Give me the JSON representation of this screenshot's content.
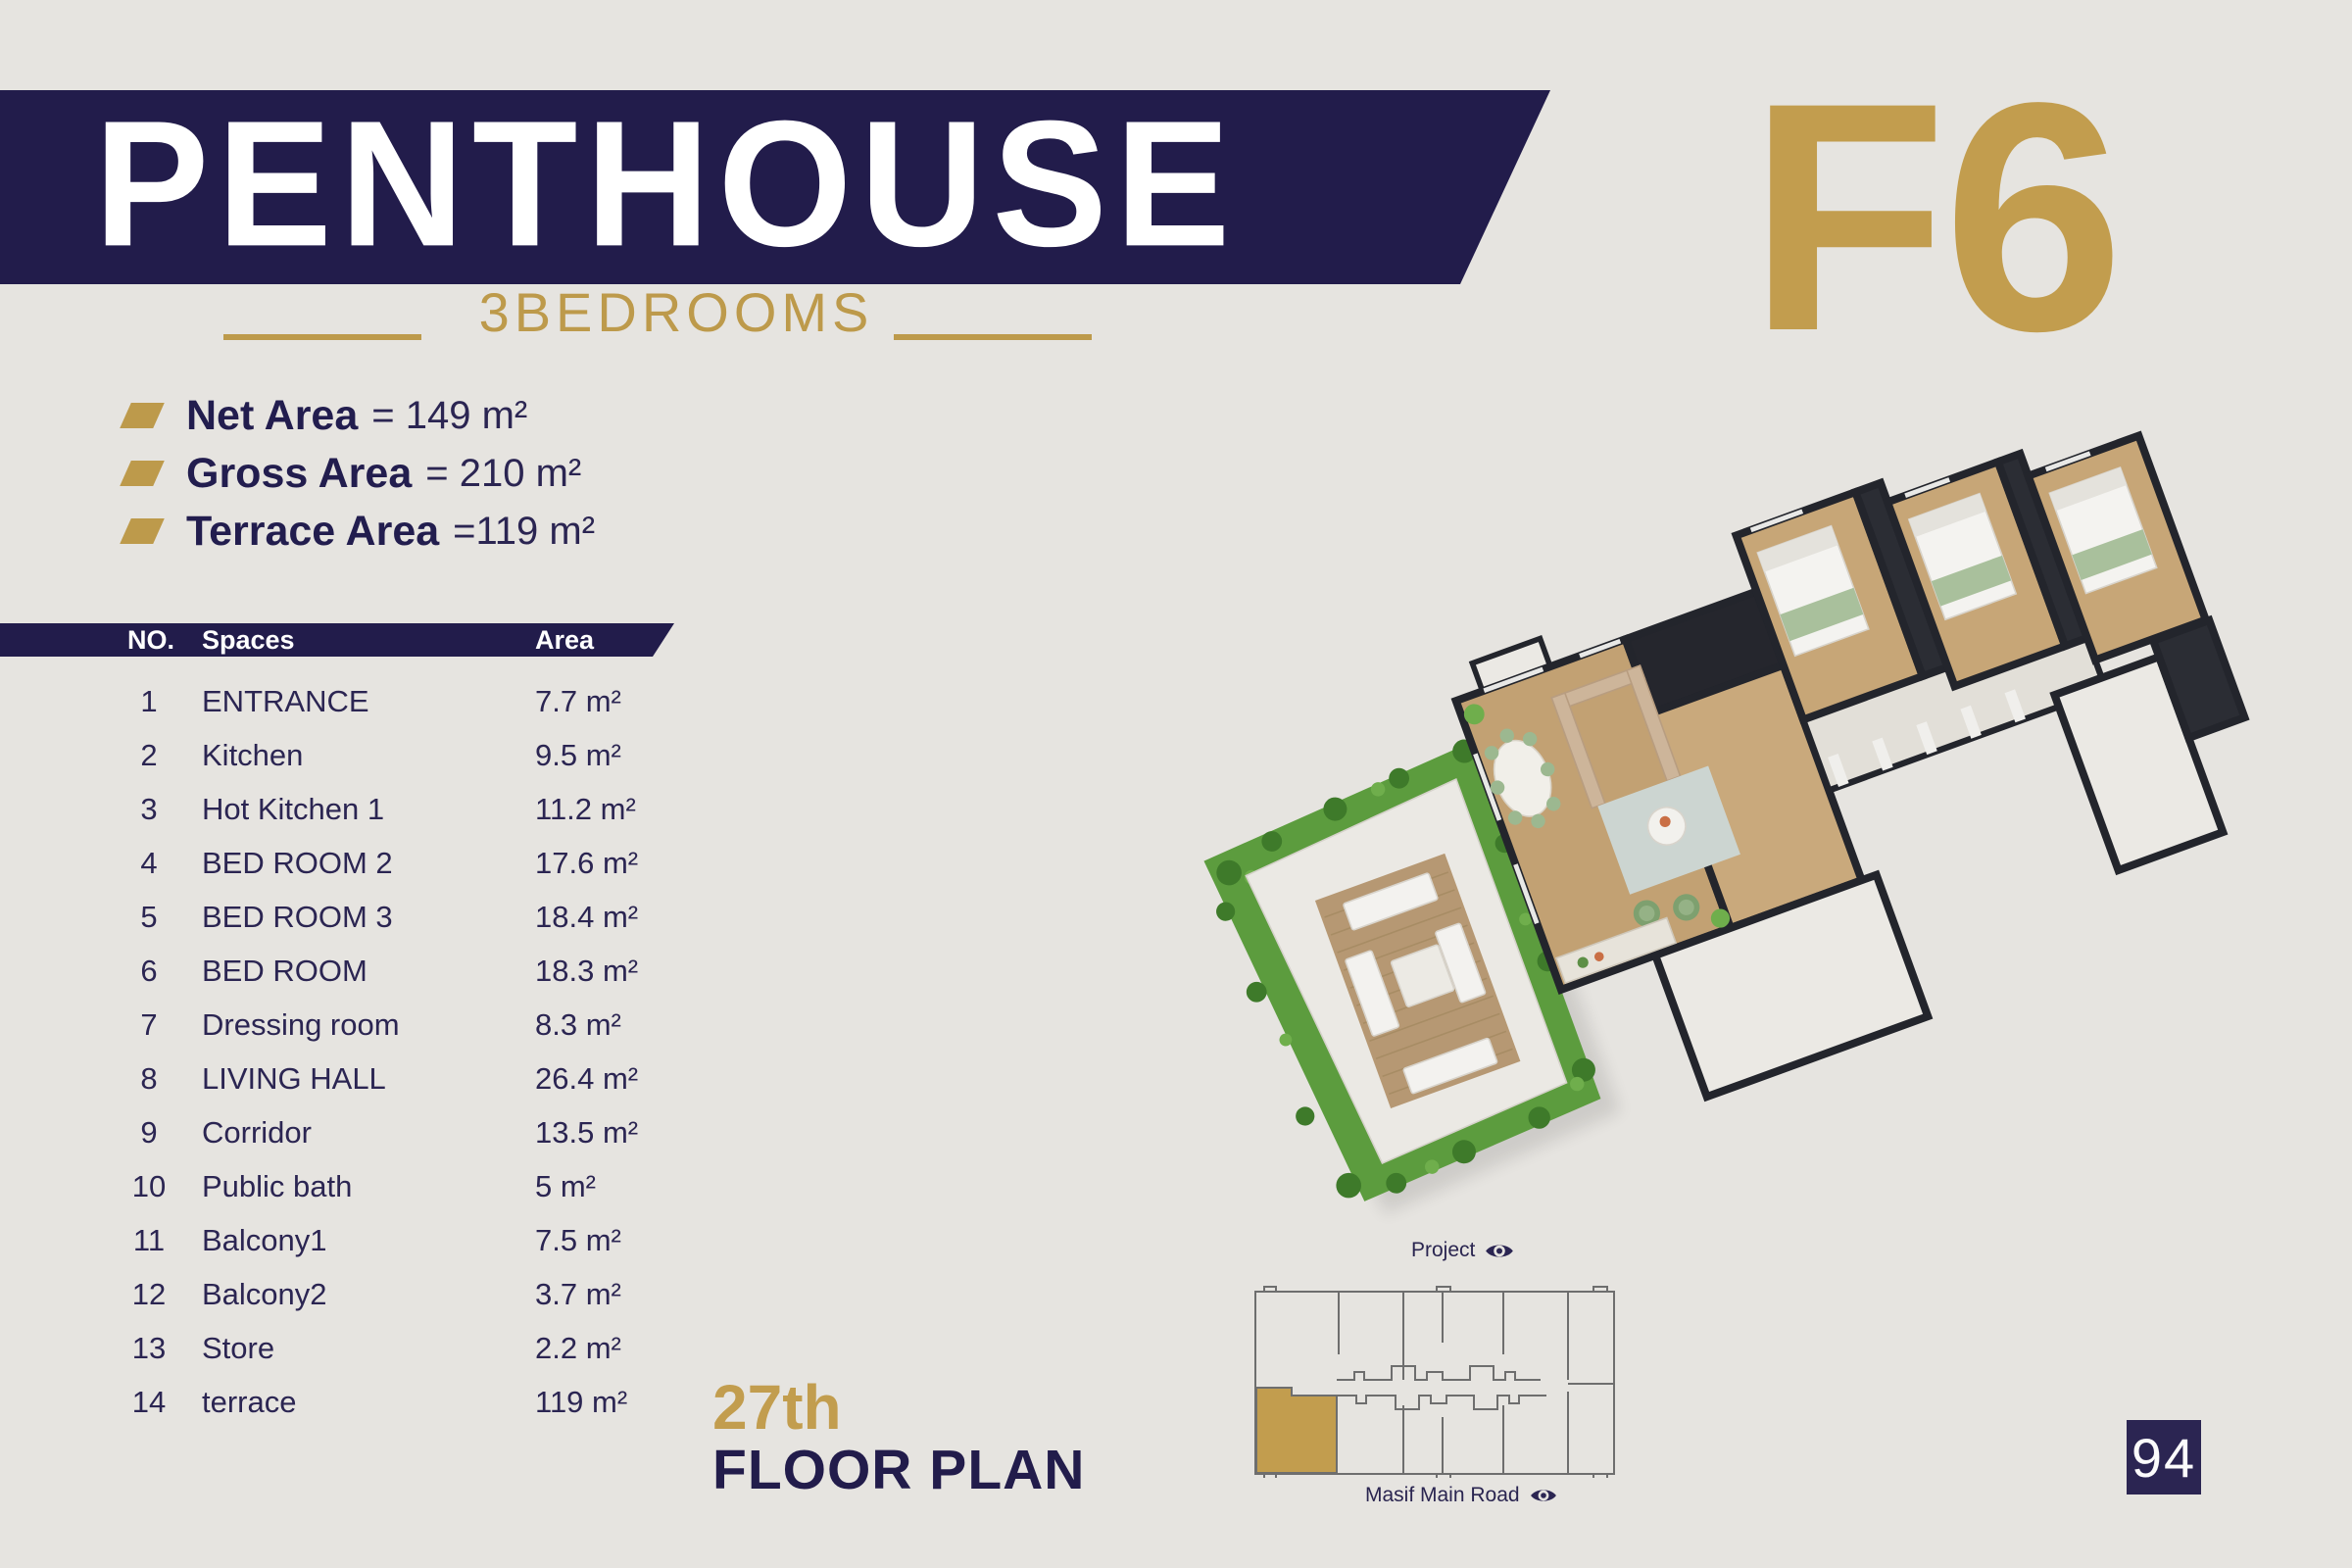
{
  "page": {
    "number": "94"
  },
  "colors": {
    "navy": "#221c4b",
    "gold": "#c29d4e",
    "background": "#e6e4e0"
  },
  "header": {
    "title": "PENTHOUSE",
    "subtitle": "3BEDROOMS",
    "unit_code": "F6"
  },
  "summary": {
    "items": [
      {
        "label": "Net Area",
        "value": "= 149 m²"
      },
      {
        "label": "Gross Area",
        "value": "= 210 m²"
      },
      {
        "label": "Terrace Area",
        "value": "=119 m²"
      }
    ]
  },
  "table": {
    "headers": {
      "no": "NO.",
      "spaces": "Spaces",
      "area": "Area"
    },
    "rows": [
      {
        "no": "1",
        "name": "ENTRANCE",
        "area": "7.7 m²"
      },
      {
        "no": "2",
        "name": "Kitchen",
        "area": "9.5 m²"
      },
      {
        "no": "3",
        "name": "Hot Kitchen  1",
        "area": "11.2 m²"
      },
      {
        "no": "4",
        "name": "BED ROOM 2",
        "area": "17.6 m²"
      },
      {
        "no": "5",
        "name": "BED ROOM 3",
        "area": "18.4 m²"
      },
      {
        "no": "6",
        "name": "BED ROOM",
        "area": "18.3 m²"
      },
      {
        "no": "7",
        "name": "Dressing room",
        "area": "8.3 m²"
      },
      {
        "no": "8",
        "name": "LIVING HALL",
        "area": "26.4 m²"
      },
      {
        "no": "9",
        "name": "Corridor",
        "area": "13.5 m²"
      },
      {
        "no": "10",
        "name": "Public bath",
        "area": "5 m²"
      },
      {
        "no": "11",
        "name": "Balcony1",
        "area": "7.5 m²"
      },
      {
        "no": "12",
        "name": "Balcony2",
        "area": "3.7 m²"
      },
      {
        "no": "13",
        "name": "Store",
        "area": "2.2 m²"
      },
      {
        "no": "14",
        "name": "terrace",
        "area": "119 m²"
      }
    ]
  },
  "floor": {
    "ordinal": "27th",
    "label": "FLOOR PLAN"
  },
  "site_map": {
    "top_label": "Project",
    "bottom_label": "Masif Main Road"
  }
}
